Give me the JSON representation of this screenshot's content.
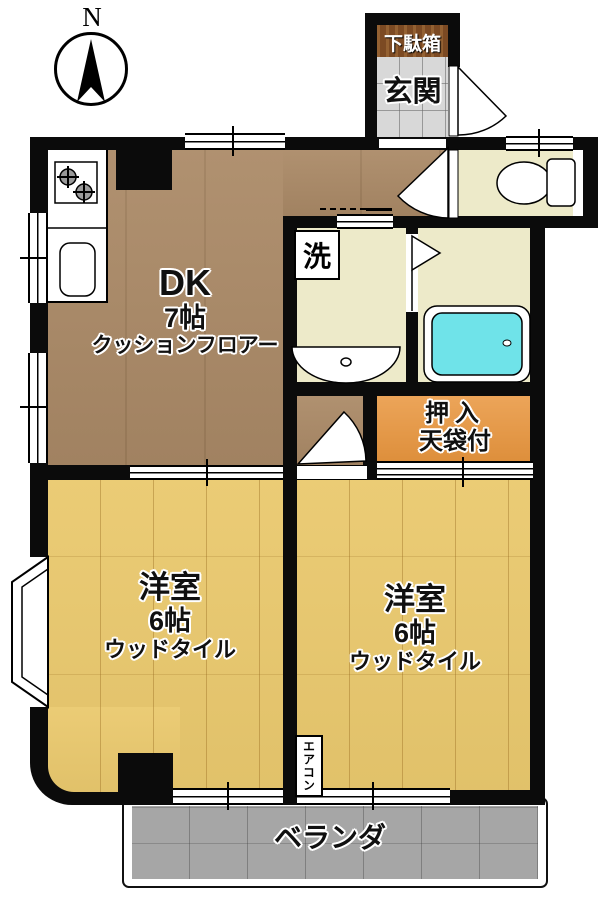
{
  "compass": {
    "north_label": "N"
  },
  "rooms": {
    "dk": {
      "name": "DK",
      "size": "7帖",
      "floor_type": "クッションフロアー"
    },
    "western_left": {
      "name": "洋室",
      "size": "6帖",
      "floor_type": "ウッドタイル"
    },
    "western_right": {
      "name": "洋室",
      "size": "6帖",
      "floor_type": "ウッドタイル"
    },
    "entrance": {
      "name": "玄関"
    },
    "shoe_cabinet": {
      "name": "下駄箱"
    },
    "closet": {
      "name": "押入",
      "note": "天袋付"
    },
    "laundry_marker": {
      "name": "洗"
    },
    "air_conditioner": {
      "name": "エアコン"
    },
    "veranda": {
      "name": "ベランダ"
    }
  },
  "colors": {
    "dk_floor": "#ab8a67",
    "wood_floor": "#eac96e",
    "wet_floor": "#edeac9",
    "entrance_tile": "#d8d8d8",
    "shoe_cabinet": "#7c4a23",
    "closet": "#e9963e",
    "bathtub": "#6fe3e9",
    "veranda": "#a6a6a6",
    "wall": "#0b0b0b"
  }
}
